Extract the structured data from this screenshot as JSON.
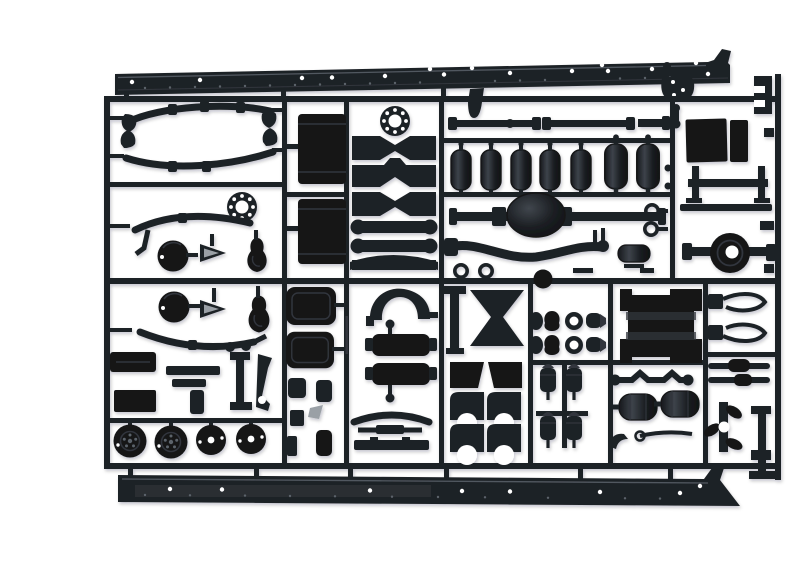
{
  "image": {
    "subject": "Photograph of a black injection-moulded plastic model kit sprue (runner) holding unpainted truck chassis parts on a plain white background",
    "caption": "Model kit sprue — truck chassis parts frame",
    "width_px": 800,
    "height_px": 530
  },
  "colors": {
    "background": "#ffffff",
    "plastic": "#1f2227",
    "plastic_deep": "#131518",
    "plastic_mid": "#31363c",
    "plastic_highlight": "#5b636b",
    "gray_part": "#9aa0a6",
    "shadow": "rgba(15,17,20,0.25)"
  },
  "sprue": {
    "frame_label": "rectangular runner frame with internal ribs dividing part compartments",
    "parts": [
      {
        "id": "chassis-rail-top",
        "label": "ladder-frame side rail with rivet holes (upper)",
        "count": 1
      },
      {
        "id": "chassis-rail-bottom",
        "label": "ladder-frame side rail with rivet holes (lower)",
        "count": 1
      },
      {
        "id": "leaf-springs",
        "label": "leaf-spring packs with hangers",
        "count": 4
      },
      {
        "id": "hub-flanges",
        "label": "drilled wheel hub flanges",
        "count": 2
      },
      {
        "id": "fuel-tank-halves",
        "label": "rectangular fuel tank halves",
        "count": 2
      },
      {
        "id": "cross-members",
        "label": "frame cross members",
        "count": 6
      },
      {
        "id": "drive-shafts",
        "label": "drive shafts with universal joints",
        "count": 2
      },
      {
        "id": "air-reservoirs",
        "label": "cylindrical air reservoirs",
        "count": 7
      },
      {
        "id": "rear-axle",
        "label": "rear axle with differential dome",
        "count": 1
      },
      {
        "id": "front-axle-beam",
        "label": "dropped front axle beam",
        "count": 1
      },
      {
        "id": "tow-rings",
        "label": "towing eyes",
        "count": 4
      },
      {
        "id": "banjo-axle-housing",
        "label": "banjo axle housing with hub bore",
        "count": 1
      },
      {
        "id": "panel-blanks",
        "label": "flat dark panel blanks",
        "count": 2
      },
      {
        "id": "h-bracket",
        "label": "H-shaped support bracket",
        "count": 1
      },
      {
        "id": "brake-drums",
        "label": "round brake-drum faces",
        "count": 2
      },
      {
        "id": "teardrop-brackets",
        "label": "teardrop mudguard brackets",
        "count": 2
      },
      {
        "id": "arrow-brackets",
        "label": "arrow-shaped brackets with grey insert",
        "count": 2
      },
      {
        "id": "road-wheels",
        "label": "wheel discs (two lugged, two plain)",
        "count": 4
      },
      {
        "id": "seat-cushions",
        "label": "rounded seat cushion pads",
        "count": 2
      },
      {
        "id": "wheel-arch",
        "label": "curved wheel-arch fender",
        "count": 1
      },
      {
        "id": "round-tank-halves",
        "label": "tank halves with filler pins",
        "count": 2
      },
      {
        "id": "x-cross-member",
        "label": "waisted (hourglass) cross member",
        "count": 1
      },
      {
        "id": "fender-quarters",
        "label": "mudguard quarter blanks",
        "count": 4
      },
      {
        "id": "battery-box",
        "label": "slatted battery box",
        "count": 1
      },
      {
        "id": "walking-beam",
        "label": "walking-beam suspension bar",
        "count": 1
      },
      {
        "id": "mufflers",
        "label": "muffler cylinders",
        "count": 2
      },
      {
        "id": "brake-chambers",
        "label": "brake chamber cylinders",
        "count": 4
      },
      {
        "id": "steering-knuckles",
        "label": "steering knuckle / booster sets",
        "count": 2
      },
      {
        "id": "shock-absorbers",
        "label": "shock absorber rods",
        "count": 2
      },
      {
        "id": "hook-arms",
        "label": "curved hook / mirror arms",
        "count": 2
      },
      {
        "id": "small-fittings",
        "label": "assorted small fittings, stubs and levers",
        "count": 1
      }
    ]
  }
}
